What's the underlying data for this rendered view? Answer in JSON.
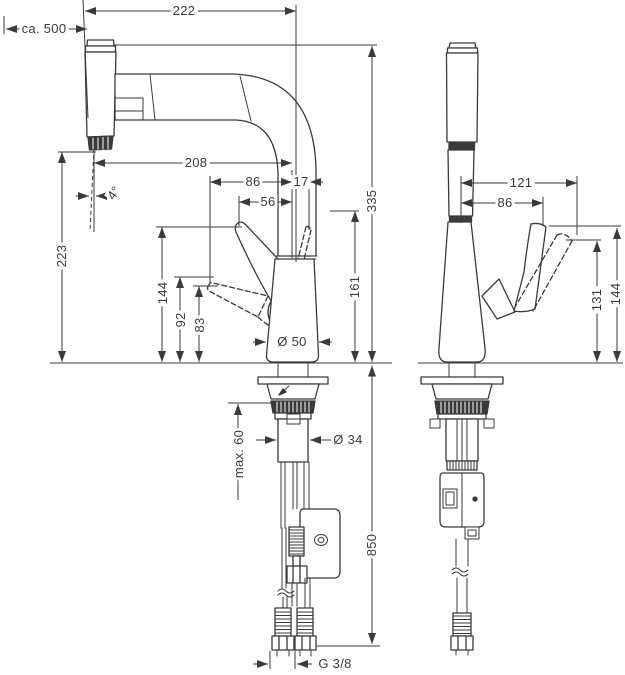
{
  "drawing": {
    "line_color": "#3a3a3a",
    "labels": {
      "total_width": "222",
      "pullout_hose_length": "ca. 500",
      "spout_reach": "208",
      "handle_forward_reach": "86",
      "handle_rear_reach": "17",
      "handle_mid_reach": "56",
      "spray_angle": "4°",
      "spout_outlet_height": "223",
      "total_height": "335",
      "spout_top_height": "161",
      "handle_top_height": "144",
      "handle_mid_height": "92",
      "handle_low_height": "83",
      "base_diameter": "Ø 50",
      "max_counter_thickness": "max. 60",
      "shank_diameter": "Ø 34",
      "supply_hose_length": "850",
      "thread_size": "G 3/8",
      "front_handle_reach": "121",
      "front_handle_width": "86",
      "front_handle_low_height": "131",
      "front_handle_top_height": "144"
    }
  }
}
